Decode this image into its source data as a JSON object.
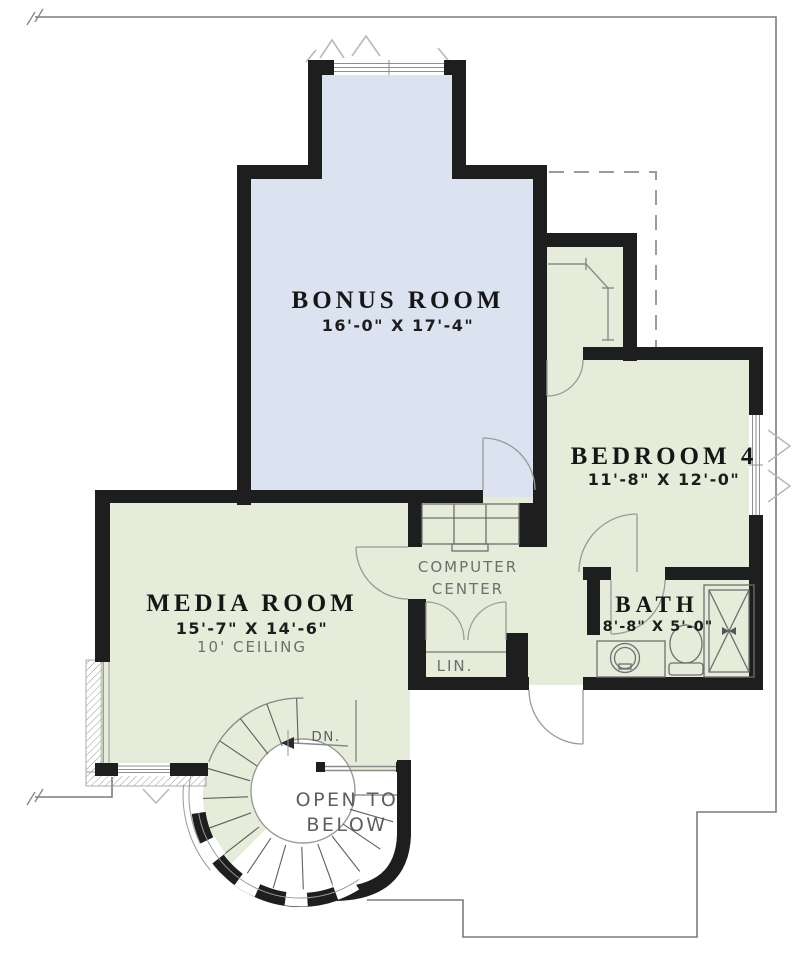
{
  "colors": {
    "room_green": "#e5ecda",
    "room_blue": "#dbe3f1",
    "wall": "#1e1e1e",
    "line_gray": "#8a8a8a",
    "text_dark": "#161616",
    "text_gray": "#6e6e6e"
  },
  "rooms": {
    "bonus": {
      "name": "BONUS ROOM",
      "dims": "16'-0\" X 17'-4\""
    },
    "media": {
      "name": "MEDIA ROOM",
      "dims": "15'-7\" X 14'-6\"",
      "ceiling": "10' CEILING"
    },
    "bedroom4": {
      "name": "BEDROOM 4",
      "dims": "11'-8\" X 12'-0\""
    },
    "bath": {
      "name": "BATH",
      "dims": "8'-8\" X 5'-0\""
    }
  },
  "labels": {
    "computer_center_line1": "COMPUTER",
    "computer_center_line2": "CENTER",
    "linen": "LIN.",
    "down": "DN.",
    "open_below_line1": "OPEN TO",
    "open_below_line2": "BELOW"
  }
}
